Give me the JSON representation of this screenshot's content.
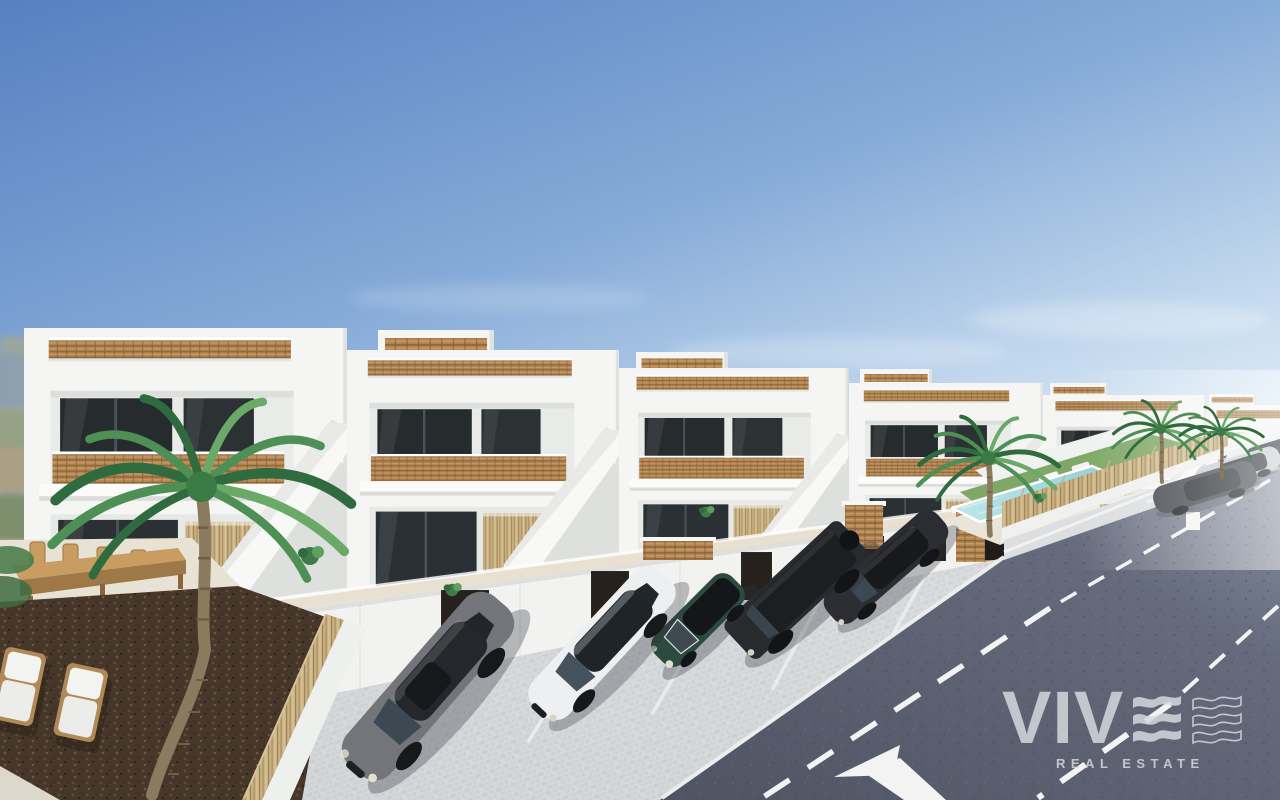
{
  "alt_text": "3D architectural render of a row of new-build white Mediterranean townhouses with rooftop solariums, wicker balustrades, external staircases, a garage row with dark doors, five cars parked on a cobbled forecourt, a communal pool with lawn and sun loungers, palm trees, an asphalt road with dashed lane markings, and an outdoor bar terrace with stools and wooden loungers in the foreground",
  "watermark": {
    "brand": "VIVE",
    "brand_prefix": "VIV",
    "brand_e_icon": "triple-wave-e-icon",
    "brand_square_icon": "triple-wave-outline-icon",
    "tagline": "REAL ESTATE",
    "color": "#d7dade"
  },
  "scene": {
    "setting": "new-build white townhouse development on a sunny day",
    "townhouses_visible": 6,
    "palm_trees": 4,
    "parking_cars": 5,
    "roadside_cars": 3,
    "features": [
      "rooftop solariums with wicker balustrades",
      "upper terraces with wicker railings",
      "external white staircases",
      "garage row with dark brown doors",
      "cobbled parking forecourt with white bay lines",
      "communal pool with lawn and two sun loungers",
      "asphalt road with two dashed lane markings and turn arrow",
      "outdoor bar counter with five stools",
      "two wooden sun loungers with white cushions",
      "dark mulch garden beds with reed fencing",
      "hazy hills on the far left horizon"
    ]
  },
  "vehicles": {
    "parking_row": [
      {
        "name": "grey-sedan",
        "color_key": "car_grey_sedan"
      },
      {
        "name": "white-sedan",
        "color_key": "car_white_sedan"
      },
      {
        "name": "green-mini-convertible",
        "color_key": "car_green_mini"
      },
      {
        "name": "black-suv",
        "color_key": "car_black_suv"
      },
      {
        "name": "black-sedan",
        "color_key": "car_black_sedan"
      }
    ],
    "roadside_row": [
      {
        "name": "dark-grey-sedan",
        "color_key": "car_dark_grey"
      },
      {
        "name": "silver-sedan",
        "color_key": "car_silver"
      },
      {
        "name": "white-suv",
        "color_key": "car_white_suv"
      }
    ]
  },
  "palette": {
    "sky_top": "#5680c1",
    "sky_mid": "#86abd8",
    "sky_low": "#c9ddf0",
    "sky_horizon": "#eff5fb",
    "building_white": "#f5f6f4",
    "building_recess": "#e9ebe8",
    "building_shadow": "#dfe2df",
    "glass_dark": "#262b2e",
    "glass_ground": "#2a3033",
    "wicker_tan": "#b5854f",
    "reed_tan": "#c9b184",
    "coping_beige": "#e8e1d1",
    "paving_light": "#d7d9db",
    "paving_dark": "#c9cccf",
    "road_dark": "#4f5463",
    "road_light": "#8a92a1",
    "marking_white": "#f2f3f2",
    "sidewalk_grey": "#dcdedf",
    "pool_water_near": "#bfe7ea",
    "pool_water_far": "#8ecfd6",
    "pool_deck": "#e9e5d9",
    "grass_green": "#7fa868",
    "palm_dark": "#2f6b3e",
    "palm_mid": "#4e8f55",
    "palm_light": "#6aa968",
    "trunk_brown": "#8a7a5e",
    "mulch_brown": "#46372a",
    "wood_tan": "#c99d62",
    "wood_dark": "#9f7847",
    "watermark_grey": "#d7dade",
    "car_grey_sedan": "#73757a",
    "car_white_sedan": "#edeff0",
    "car_green_mini": "#2c4a3d",
    "car_black_suv": "#282a2e",
    "car_black_sedan": "#2b2d32",
    "car_dark_grey": "#41454c",
    "car_silver": "#c6ccd2",
    "car_white_suv": "#e7eaec"
  }
}
